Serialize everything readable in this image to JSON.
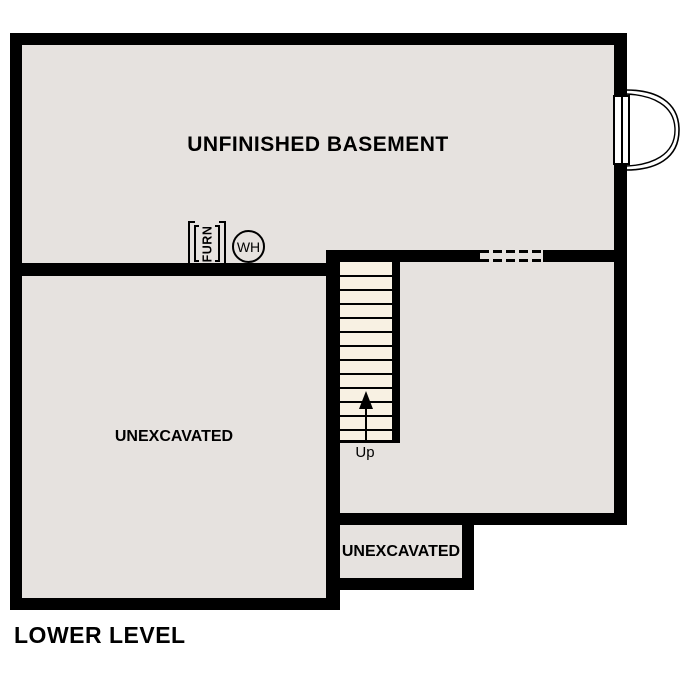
{
  "plan_title": "LOWER LEVEL",
  "rooms": {
    "basement": {
      "label": "UNFINISHED BASEMENT"
    },
    "left_unexcavated": {
      "label": "UNEXCAVATED"
    },
    "bottom_unexcavated": {
      "label": "UNEXCAVATED"
    }
  },
  "stairs": {
    "direction_label": "Up",
    "step_count": 13
  },
  "equipment": {
    "furnace_label": "FURN",
    "water_heater_label": "WH"
  },
  "colors": {
    "wall": "#000000",
    "room_fill": "#e6e2df",
    "stair_fill": "#f8f1e3",
    "window_fill": "#ffffff",
    "background": "#ffffff",
    "text": "#000000"
  }
}
